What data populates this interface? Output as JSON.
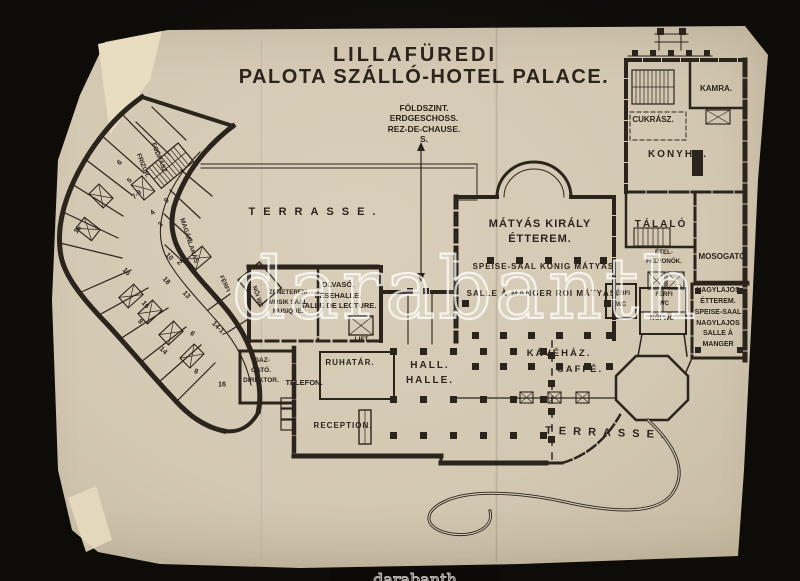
{
  "colors": {
    "background": "#14110d",
    "paper": "#d3c8b2",
    "ink": "#2b241c",
    "watermark": "#ffffff"
  },
  "watermark": {
    "text": "darabanth",
    "bottom_bar_text": "darabanth"
  },
  "header": {
    "title_line1": "LILLAFÜREDI",
    "title_line2": "PALOTA SZÁLLÓ-HOTEL PALACE.",
    "floor_note": "FÖLDSZINT.\nERDGESCHOSS.\nREZ-DE-CHAUSE.\nS."
  },
  "labels": {
    "terrasse_left": "TERRASSE.",
    "terrasse_bottom": "TERRASSE.",
    "matyas_title": "MÁTYÁS KIRÁLY\nÉTTEREM.",
    "matyas_speise": "SPEISE-SAAL KÖNIG MÁTYÁS.",
    "matyas_salle": "SALLE À MANGER ROI MÁTYÁS.",
    "kavehaz": "KÁVÉHÁZ.",
    "caffe": "CAFFÉ.",
    "hall": "HALL.\nHALLE.",
    "reception": "RECEPTION.",
    "ruhatar": "RUHATÁR.",
    "telefon": "TELEFON.",
    "igazgato": "IGAZ-\nGATÓ.\nDIREKTOR.",
    "olvaso": "OLVASÓ.\nLESEHALLE.\nSALLE DE LECTURE.",
    "zeneterem": "ZENETEREM\nMUSIK SAAL\nMUSIQUE.",
    "lift": "LIFT.",
    "talalo": "TÁLALÓ",
    "kamra": "KAMRA.",
    "cukrasz": "CUKRÁSZ.",
    "konyha": "KONYHA.",
    "mosogato": "MOSOGATÓ",
    "etel_felvonok": "ÉTEL-\nFELVONÓK.",
    "ferfi_wc_1": "FÉRFI\nWC",
    "ferfi_wc_2": "FÉRFI\nWC",
    "noi_wc": "NŐI WC",
    "nagylajos": "NAGYLAJOS\nÉTTEREM.\nSPEISE-SAAL\nNAGYLAJOS\nSALLE À\nMANGER",
    "fodrasz": "FODRÁSZ",
    "frizur": "FRIZUR.",
    "maganlakas": "MAGÁNLAKÁS",
    "wing_ferfi": "FÉRFI",
    "wing_noi": "NŐI WC"
  },
  "wing_room_numbers": [
    "6",
    "5",
    "7-9",
    "9",
    "4",
    "3",
    "16",
    "10",
    "2",
    "16",
    "18",
    "13",
    "16",
    "8",
    "6",
    "14",
    "14-17",
    "8",
    "16"
  ]
}
